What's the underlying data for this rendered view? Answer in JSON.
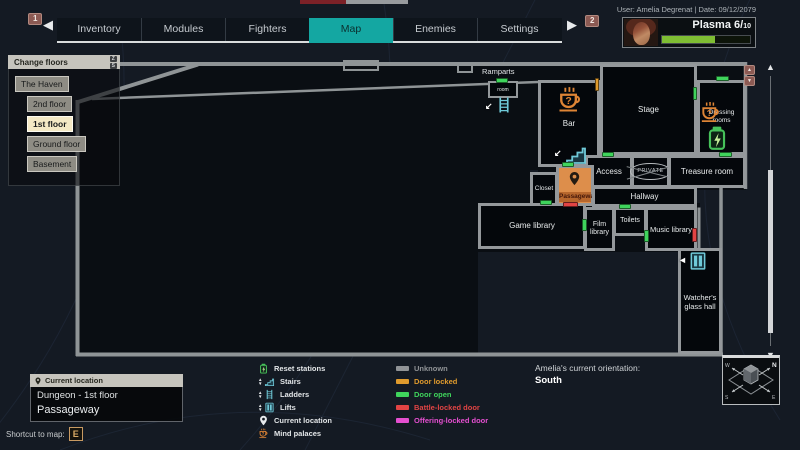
{
  "top_bar": {
    "page_badge_left": "1",
    "page_badge_right": "2",
    "prev_arrow": "◀",
    "next_arrow": "▶",
    "tabs": [
      {
        "label": "Inventory"
      },
      {
        "label": "Modules"
      },
      {
        "label": "Fighters"
      },
      {
        "label": "Map",
        "active": true
      },
      {
        "label": "Enemies"
      },
      {
        "label": "Settings"
      }
    ],
    "user_info": "User: Amelia Degrenat | Date: 09/12/2079"
  },
  "player": {
    "resource_label": "Plasma",
    "resource_value": "6",
    "resource_max": "10",
    "resource_percent": 60,
    "bar_color": "#7fbe33"
  },
  "floors_panel": {
    "title": "Change floors",
    "key_up": "Z",
    "key_down": "S",
    "floors": [
      {
        "label": "The Haven"
      },
      {
        "label": "2nd floor"
      },
      {
        "label": "1st floor",
        "selected": true
      },
      {
        "label": "Ground floor"
      },
      {
        "label": "Basement"
      }
    ]
  },
  "map": {
    "rooms": [
      {
        "label": "Ramparts"
      },
      {
        "label": "room"
      },
      {
        "label": "Bar"
      },
      {
        "label": "Stage"
      },
      {
        "label": "Dressing rooms"
      },
      {
        "label": "Access"
      },
      {
        "label": "PRIVATE"
      },
      {
        "label": "Treasure room"
      },
      {
        "label": "Closet"
      },
      {
        "label": "Passageway"
      },
      {
        "label": "Hallway"
      },
      {
        "label": "Game library"
      },
      {
        "label": "Film library"
      },
      {
        "label": "Toilets"
      },
      {
        "label": "Music library"
      },
      {
        "label": "Watcher's glass hall"
      }
    ],
    "doors": [
      {
        "x": 496,
        "y": 78,
        "w": 12,
        "h": 5,
        "type": "open"
      },
      {
        "x": 595,
        "y": 78,
        "w": 4,
        "h": 13,
        "type": "locked"
      },
      {
        "x": 693,
        "y": 87,
        "w": 4,
        "h": 13,
        "type": "open"
      },
      {
        "x": 716,
        "y": 76,
        "w": 13,
        "h": 5,
        "type": "open"
      },
      {
        "x": 719,
        "y": 152,
        "w": 13,
        "h": 5,
        "type": "open"
      },
      {
        "x": 602,
        "y": 152,
        "w": 12,
        "h": 5,
        "type": "open"
      },
      {
        "x": 562,
        "y": 162,
        "w": 12,
        "h": 5,
        "type": "open"
      },
      {
        "x": 540,
        "y": 200,
        "w": 12,
        "h": 5,
        "type": "open"
      },
      {
        "x": 563,
        "y": 202,
        "w": 15,
        "h": 5,
        "type": "battle"
      },
      {
        "x": 582,
        "y": 219,
        "w": 5,
        "h": 12,
        "type": "open"
      },
      {
        "x": 619,
        "y": 204,
        "w": 12,
        "h": 5,
        "type": "open"
      },
      {
        "x": 644,
        "y": 230,
        "w": 5,
        "h": 12,
        "type": "open"
      },
      {
        "x": 692,
        "y": 228,
        "w": 5,
        "h": 14,
        "type": "battle"
      }
    ],
    "icons": [
      {
        "icon": "mind-palace",
        "x": 556,
        "y": 86,
        "s": 28
      },
      {
        "icon": "mind-palace",
        "x": 699,
        "y": 101,
        "s": 23
      },
      {
        "icon": "reset-station",
        "x": 704,
        "y": 125,
        "s": 26
      },
      {
        "icon": "stairs",
        "x": 564,
        "y": 142,
        "s": 24,
        "arrow": "↙",
        "ax": 554,
        "ay": 148
      },
      {
        "icon": "ladder",
        "x": 495,
        "y": 96,
        "s": 18,
        "arrow": "↙",
        "ax": 485,
        "ay": 101
      },
      {
        "icon": "lift",
        "x": 688,
        "y": 251,
        "s": 20,
        "arrow": "◄",
        "ax": 678,
        "ay": 255
      },
      {
        "icon": "pin-dark",
        "x": 567,
        "y": 171,
        "s": 15
      }
    ]
  },
  "legend": {
    "features": [
      {
        "icon": "reset-station",
        "label": "Reset stations"
      },
      {
        "icon": "stairs",
        "label": "Stairs"
      },
      {
        "icon": "ladder",
        "label": "Ladders"
      },
      {
        "icon": "lift",
        "label": "Lifts"
      },
      {
        "icon": "pin",
        "label": "Current location"
      },
      {
        "icon": "mind-palace",
        "label": "Mind palaces"
      }
    ],
    "door_types": [
      {
        "type": "unknown",
        "label": "Unknown",
        "color": "#909396"
      },
      {
        "type": "locked",
        "label": "Door locked",
        "color": "#e09b2d"
      },
      {
        "type": "open",
        "label": "Door open",
        "color": "#3fd45c"
      },
      {
        "type": "battle",
        "label": "Battle-locked door",
        "color": "#e24444"
      },
      {
        "type": "offering",
        "label": "Offering-locked door",
        "color": "#e54fd0"
      }
    ]
  },
  "orientation": {
    "label": "Amelia's current orientation:",
    "value": "South"
  },
  "location_panel": {
    "header": "Current location",
    "area": "Dungeon - 1st floor",
    "room": "Passageway"
  },
  "shortcut": {
    "label": "Shortcut to map:",
    "key": "E"
  },
  "compass": {
    "n": "N",
    "e": "E",
    "s": "S",
    "w": "W"
  }
}
